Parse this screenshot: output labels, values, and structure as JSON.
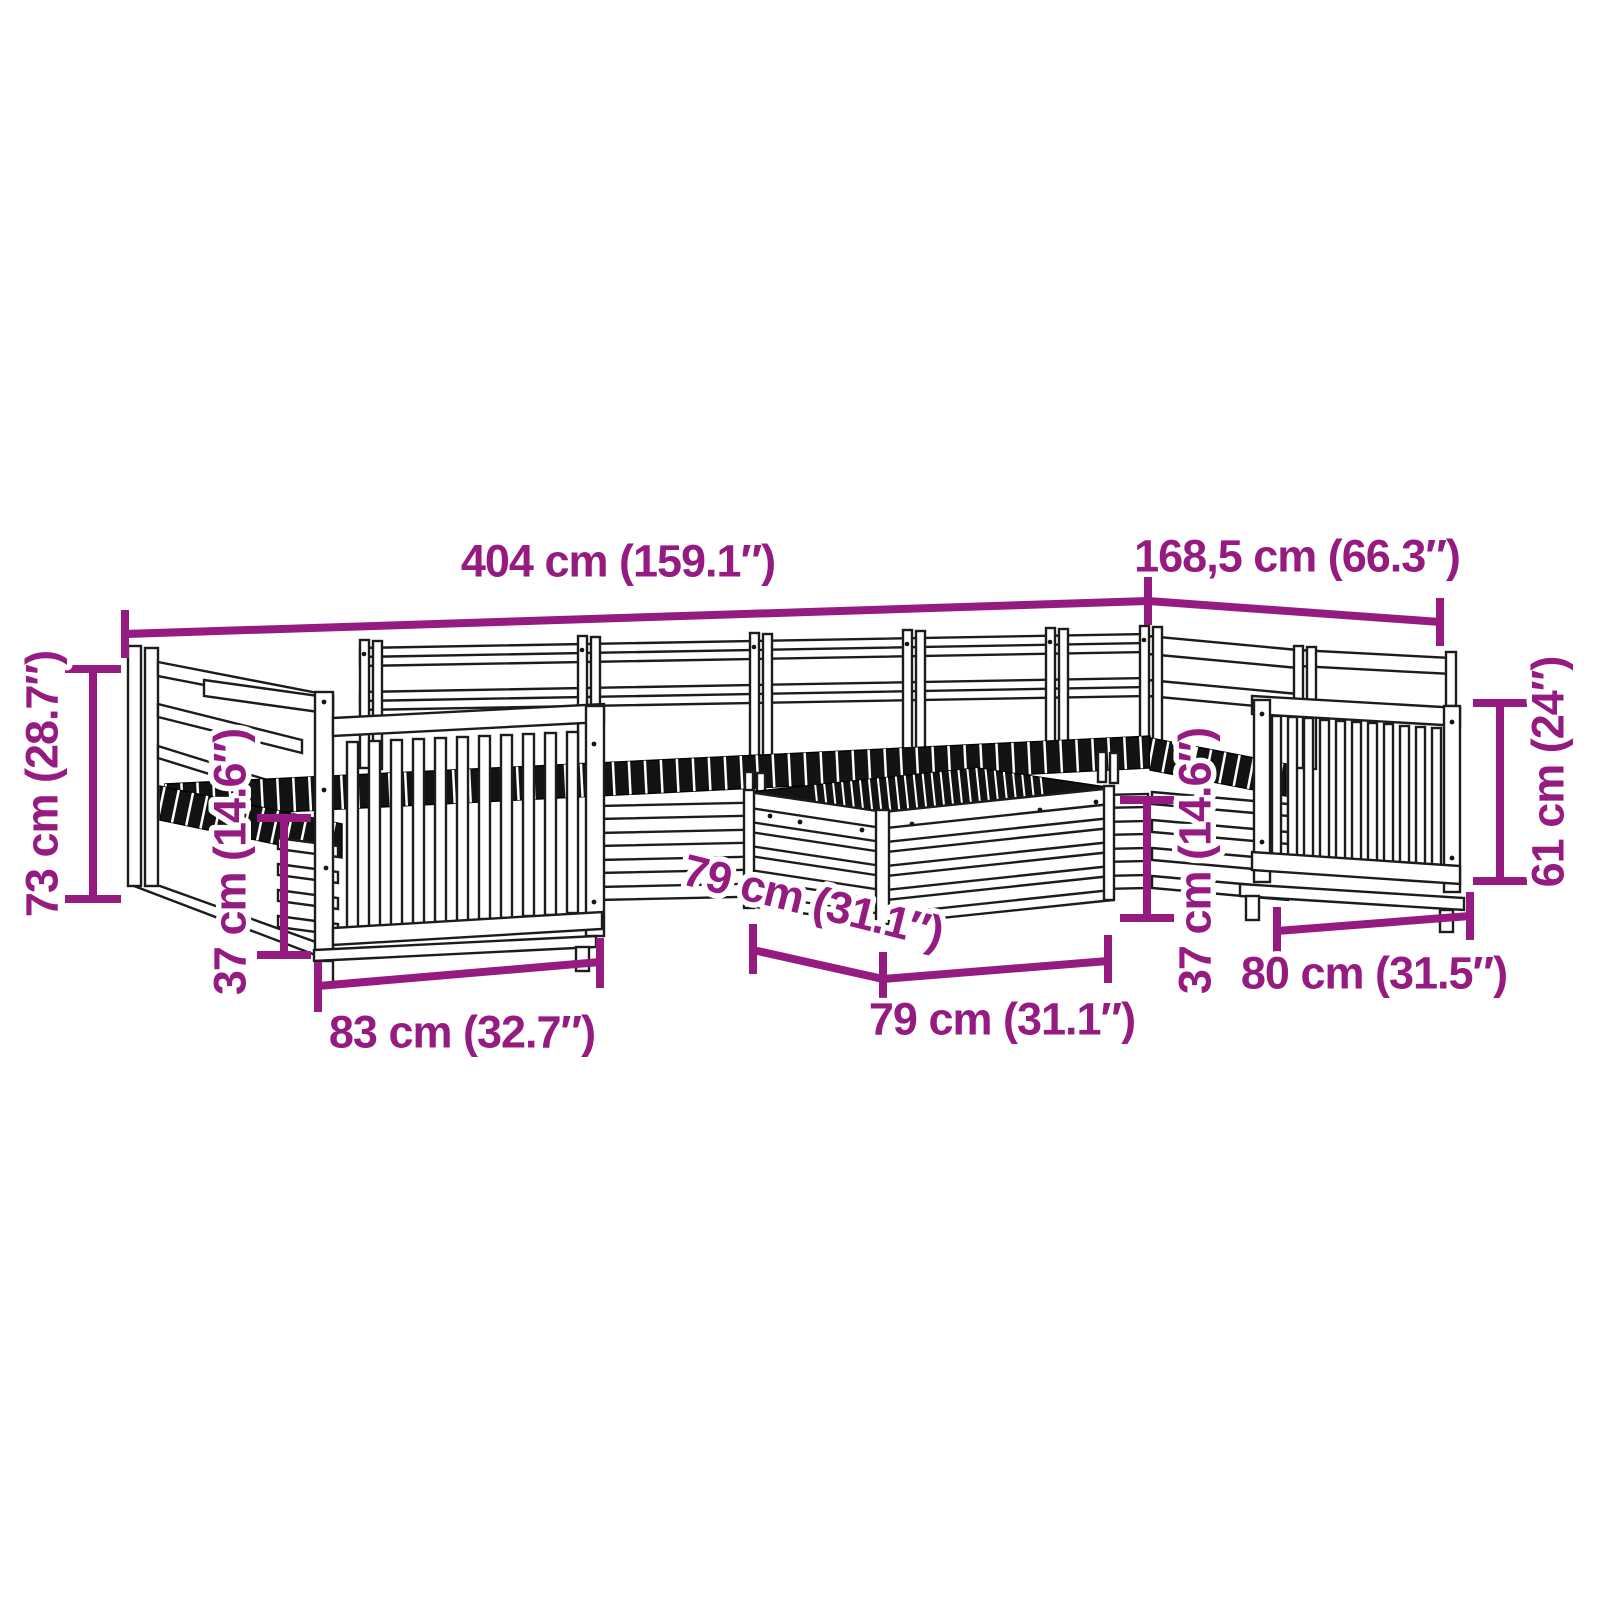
{
  "colors": {
    "accent": "#951B81",
    "line": "#1c1c1c",
    "seat_fill": "#131313",
    "background": "#ffffff"
  },
  "diagram": {
    "kind": "furniture dimension diagram",
    "subject": "wooden garden lounge set (U-shaped modular sofa with slatted armchairs and coffee table), black line drawing with magenta dimensions"
  },
  "dims": {
    "overall_width": "404 cm (159.1″)",
    "overall_depth": "168,5 cm (66.3″)",
    "overall_height": "73 cm (28.7″)",
    "seat_height_left": "37 cm (14.6″)",
    "left_armchair_width": "83 cm (32.7″)",
    "table_depth": "79 cm (31.1″)",
    "table_width": "79 cm (31.1″)",
    "seat_height_right": "37 cm (14.6″)",
    "right_armchair_width": "80 cm (31.5″)",
    "backrest_height": "61 cm (24″)"
  }
}
